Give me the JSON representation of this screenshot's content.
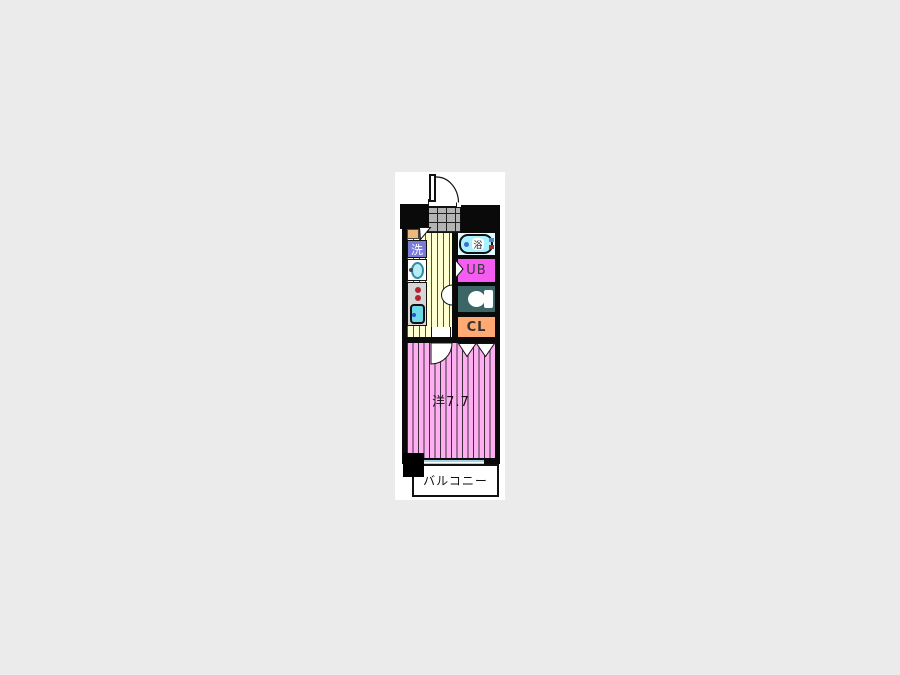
{
  "floorplan": {
    "labels": {
      "washer": "洗",
      "bath": "浴",
      "unit_bath": "UB",
      "closet": "CL",
      "main_room": "洋7.7",
      "balcony": "バルコニー"
    },
    "colors": {
      "page_background": "#ebebeb",
      "panel_background": "#ffffff",
      "wall": "#0a0a0a",
      "tile_floor": "#b4b4b4",
      "hall_floor_yellow": "#ffffd2",
      "room_pink": "#ffaef2",
      "washer_purple": "#7a7ad8",
      "unit_bath_magenta": "#f55cf2",
      "toilet_teal": "#3c6666",
      "closet_orange": "#ffaa72",
      "bath_room_cyan": "#e2fbff",
      "bathtub_cyan": "#a8f2ff",
      "entry_step_tan": "#efb87c",
      "window_glass": "#9fd4e4",
      "kitchen_gray": "#d6d6d6",
      "burner_red": "#b02434",
      "sink_cyan": "#6cd8e8"
    }
  }
}
